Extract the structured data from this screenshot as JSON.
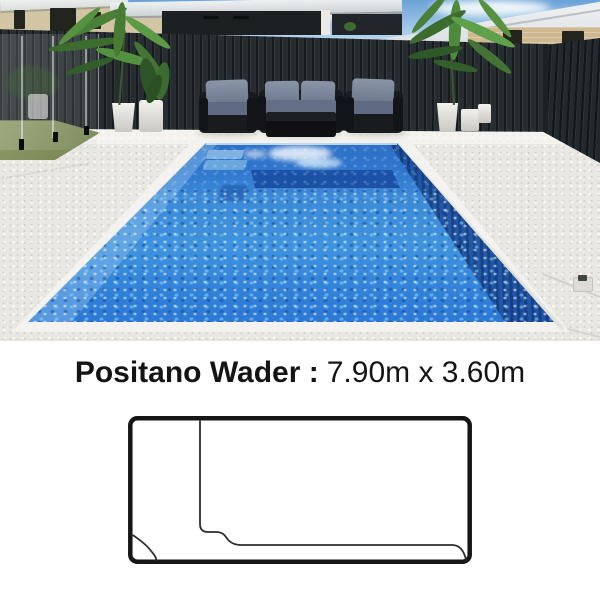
{
  "product": {
    "name": "Positano Wader :",
    "dimensions": "7.90m x 3.60m",
    "length": "7.90m",
    "width": "3.60m"
  },
  "photo": {
    "description": "Backyard fibreglass swimming pool with dark colorbond fence, glass pool fence, outdoor wicker lounge set with grey cushions, potted palms in white pots, and white aggregate paving"
  },
  "diagram": {
    "type": "pool-plan-outline",
    "label": "Positano Wader plan view with wader ledge and corner steps"
  },
  "theme": {
    "colors": {
      "sky": "#6aa2d6",
      "fence": "#272d30",
      "paving": "#e9e7e2",
      "wall_cream": "#d2c5a3",
      "brick": "#cdb88f",
      "wicker": "#191c1f",
      "cushion": "#8a95a8",
      "lawn": "#75834e",
      "water_top": "#2d6bc2",
      "water_mid": "#3f93de",
      "water_deep": "#2a74d2",
      "bench_blue": "#1b52a8",
      "step_blue": "#7fb2e2",
      "line": "#161616"
    }
  }
}
